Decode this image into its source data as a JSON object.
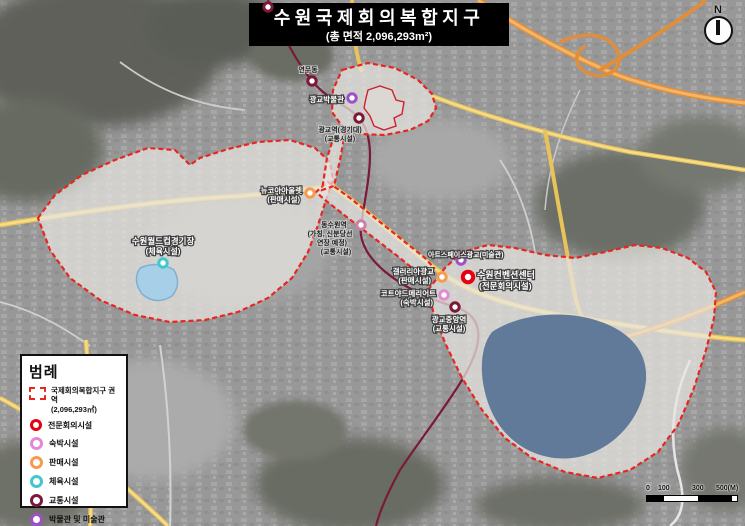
{
  "title": {
    "main": "수원국제회의복합지구",
    "subtitle": "(총 면적 2,096,293m²)"
  },
  "compass": {
    "label": "N"
  },
  "legend": {
    "title": "범례",
    "zone": {
      "label": "국제회의복합지구 권역",
      "area": "(2,096,293㎡)",
      "color": "#e8251f"
    },
    "items": [
      {
        "label": "전문회의시설",
        "color": "#e60012"
      },
      {
        "label": "숙박시설",
        "color": "#e38ad6"
      },
      {
        "label": "판매시설",
        "color": "#f59b50"
      },
      {
        "label": "체육시설",
        "color": "#40c8d0"
      },
      {
        "label": "교통시설",
        "color": "#7a1a38"
      },
      {
        "label": "박물관 및 미술관",
        "color": "#9d50c8"
      }
    ]
  },
  "scalebar": {
    "labels": [
      "0",
      "100",
      "300",
      "500(M)"
    ]
  },
  "map": {
    "district_fill": "rgba(232,230,226,0.72)",
    "boundary_color": "#e8251f",
    "lake_color": "#627a9a",
    "metro_line_color": "#7a1a38",
    "labels": [
      {
        "text": "수원월드컵경기장"
      },
      {
        "text": "(체육시설)"
      },
      {
        "text": "연무동"
      },
      {
        "text": "광교박물관"
      },
      {
        "text": "광교역(경기대)"
      },
      {
        "text": "(교통시설)"
      },
      {
        "text": "뉴코아아울렛"
      },
      {
        "text": "(판매시설)"
      },
      {
        "text": "동수원역"
      },
      {
        "text": "(가칭, 신분당선"
      },
      {
        "text": "연장 예정)"
      },
      {
        "text": "(교통시설)"
      },
      {
        "text": "갤러리아광교"
      },
      {
        "text": "(판매시설)"
      },
      {
        "text": "아트스페이스광교(미술관)"
      },
      {
        "text": "수원컨벤션센터"
      },
      {
        "text": "(전문회의시설)"
      },
      {
        "text": "코트야드메리어트"
      },
      {
        "text": "(숙박시설)"
      },
      {
        "text": "광교중앙역"
      },
      {
        "text": "(교통시설)"
      }
    ],
    "markers": [
      {
        "name": "station-top-edge",
        "color": "#7a1a38"
      },
      {
        "name": "station-yeonmu",
        "color": "#7a1a38"
      },
      {
        "name": "gwanggyo-museum",
        "color": "#9d50c8"
      },
      {
        "name": "gwanggyo-station",
        "color": "#7a1a38"
      },
      {
        "name": "newcore-outlet",
        "color": "#f59b50"
      },
      {
        "name": "dongsuwon-station-planned",
        "color": "#cc7fa8"
      },
      {
        "name": "galleria-gwanggyo",
        "color": "#f59b50"
      },
      {
        "name": "artspace-gwanggyo",
        "color": "#9d50c8"
      },
      {
        "name": "suwon-convention-center",
        "color": "#e60012"
      },
      {
        "name": "courtyard-marriott",
        "color": "#e38ad6"
      },
      {
        "name": "gwanggyo-jungang-station",
        "color": "#7a1a38"
      },
      {
        "name": "world-cup-stadium",
        "color": "#40c8d0"
      }
    ]
  }
}
